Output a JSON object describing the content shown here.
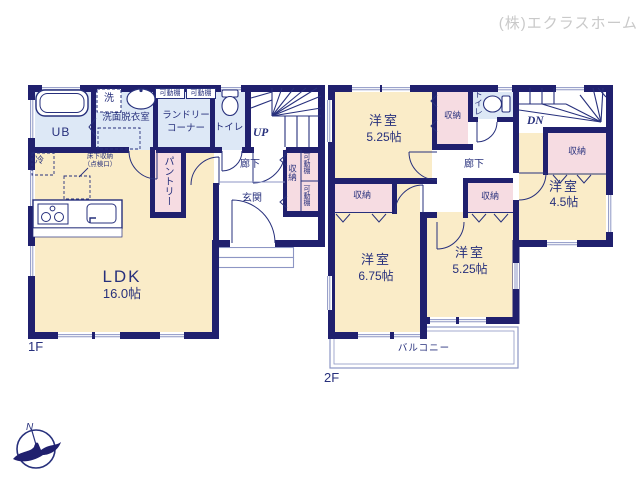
{
  "watermark": "(株)エクラスホーム",
  "compass": {
    "north": "N"
  },
  "colors": {
    "wall": "#20206e",
    "room_fill": "#faecc8",
    "wet_fill": "#dde8f6",
    "closet_fill": "#f6dce2",
    "text": "#27307c",
    "thin_line": "#8d96c4",
    "watermark": "#c9c9c9"
  },
  "floor1": {
    "floor_label": "1F",
    "ldk": {
      "name": "LDK",
      "size": "16.0帖"
    },
    "bath": "UB",
    "washer": "洗",
    "washroom": "洗面脱衣室",
    "laundry_line1": "ランドリー",
    "laundry_line2": "コーナー",
    "movable_shelf": "可動棚",
    "toilet": "トイレ",
    "stairs_up": "UP",
    "hallway": "廊下",
    "entrance": "玄関",
    "pantry": "パントリー",
    "storage": "収納",
    "fridge": "冷",
    "underfloor_line1": "床下収納",
    "underfloor_line2": "（点検口）"
  },
  "floor2": {
    "floor_label": "2F",
    "stairs_down": "DN",
    "toilet": "トイレ",
    "hallway": "廊下",
    "storage": "収納",
    "balcony": "バルコニー",
    "room_nw": {
      "name": "洋室",
      "size": "5.25帖"
    },
    "room_e": {
      "name": "洋室",
      "size": "4.5帖"
    },
    "room_sw": {
      "name": "洋室",
      "size": "6.75帖"
    },
    "room_s": {
      "name": "洋室",
      "size": "5.25帖"
    }
  }
}
